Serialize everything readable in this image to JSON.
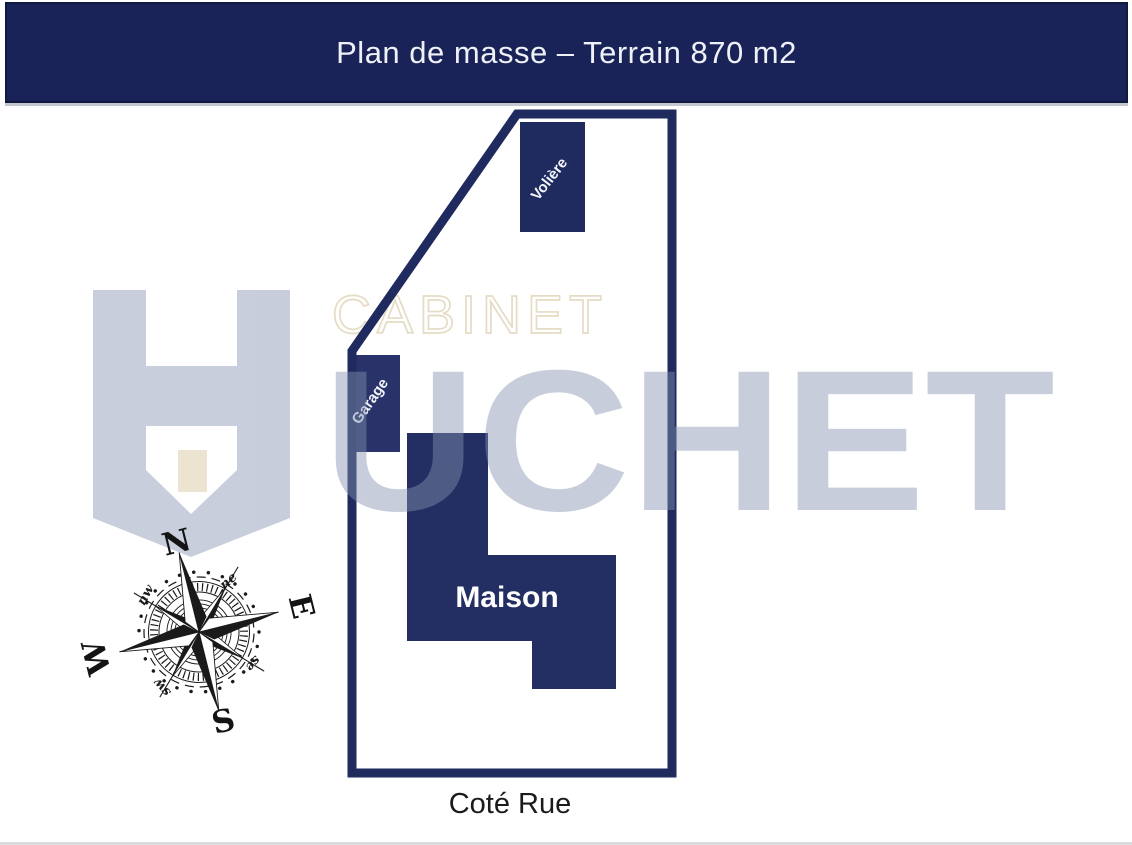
{
  "header": {
    "title": "Plan de masse – Terrain 870 m2",
    "bg_color": "#1a2357",
    "text_color": "#eef1f8"
  },
  "plan": {
    "maison_label": "Maison",
    "garage_label": "Garage",
    "voliere_label": "Volière",
    "street_label": "Coté Rue",
    "outline_color": "#1f2a5e",
    "maison_fill": "#232e62",
    "garage_fill": "#29336a",
    "voliere_fill": "#1f2a5e",
    "terrain_area": "870 m2"
  },
  "watermark": {
    "cabinet_text": "CABINET",
    "huchet_text": "HUCHET",
    "huchet_letters_after_emblem": "UCHET",
    "letters_color": "#8492af",
    "cabinet_color": "#e5dcc5",
    "door_color": "#ece4d1"
  },
  "compass": {
    "north": "N",
    "east": "E",
    "south": "S",
    "west": "W",
    "northeast": "ne",
    "northwest": "nw",
    "southeast": "se",
    "southwest": "sw"
  }
}
